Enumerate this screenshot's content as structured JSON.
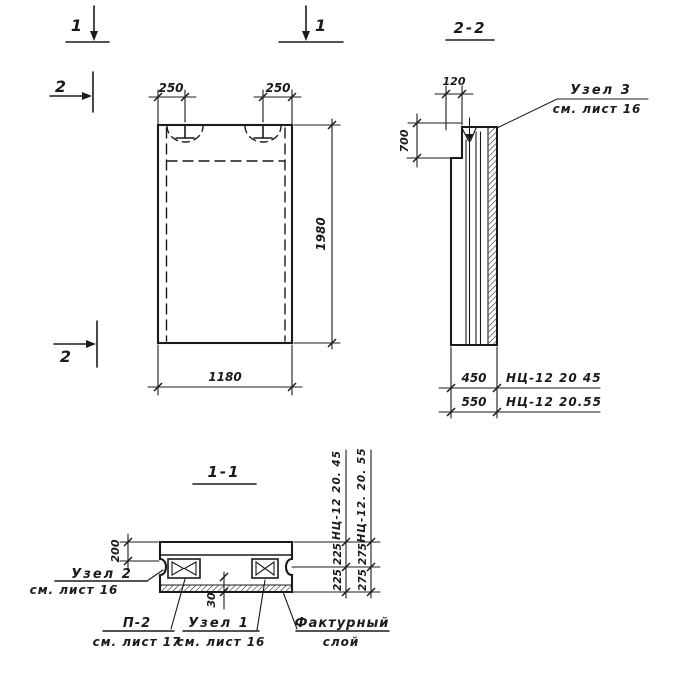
{
  "palette": {
    "ink": "#1b1b1b",
    "paper": "#ffffff"
  },
  "marks": {
    "cut1_left": "1",
    "cut1_right": "1",
    "cut2_top": "2",
    "cut2_bottom": "2"
  },
  "front": {
    "dim_loop_left": "250",
    "dim_loop_right": "250",
    "dim_height": "1980",
    "dim_width": "1180"
  },
  "section22": {
    "title": "2-2",
    "dim_top": "120",
    "dim_side": "700",
    "variant1": {
      "dim": "450",
      "mark": "НЦ-12 20 45"
    },
    "variant2": {
      "dim": "550",
      "mark": "НЦ-12 20.55"
    },
    "node3": {
      "name": "Узел 3",
      "ref": "см. лист 16"
    }
  },
  "section11": {
    "title": "1-1",
    "dim_edge": "200",
    "dim_layer": "30",
    "col1": {
      "mark": "НЦ-12 20. 45",
      "top": "225",
      "bottom": "225"
    },
    "col2": {
      "mark": "НЦ-12. 20. 55",
      "top": "275",
      "bottom": "275"
    },
    "node2": {
      "name": "Узел 2",
      "ref": "см. лист 16"
    },
    "p2": {
      "name": "П-2",
      "ref": "см. лист 17"
    },
    "node1": {
      "name": "Узел 1",
      "ref": "см. лист 16"
    },
    "facture": {
      "line1": "Фактурный",
      "line2": "слой"
    }
  }
}
